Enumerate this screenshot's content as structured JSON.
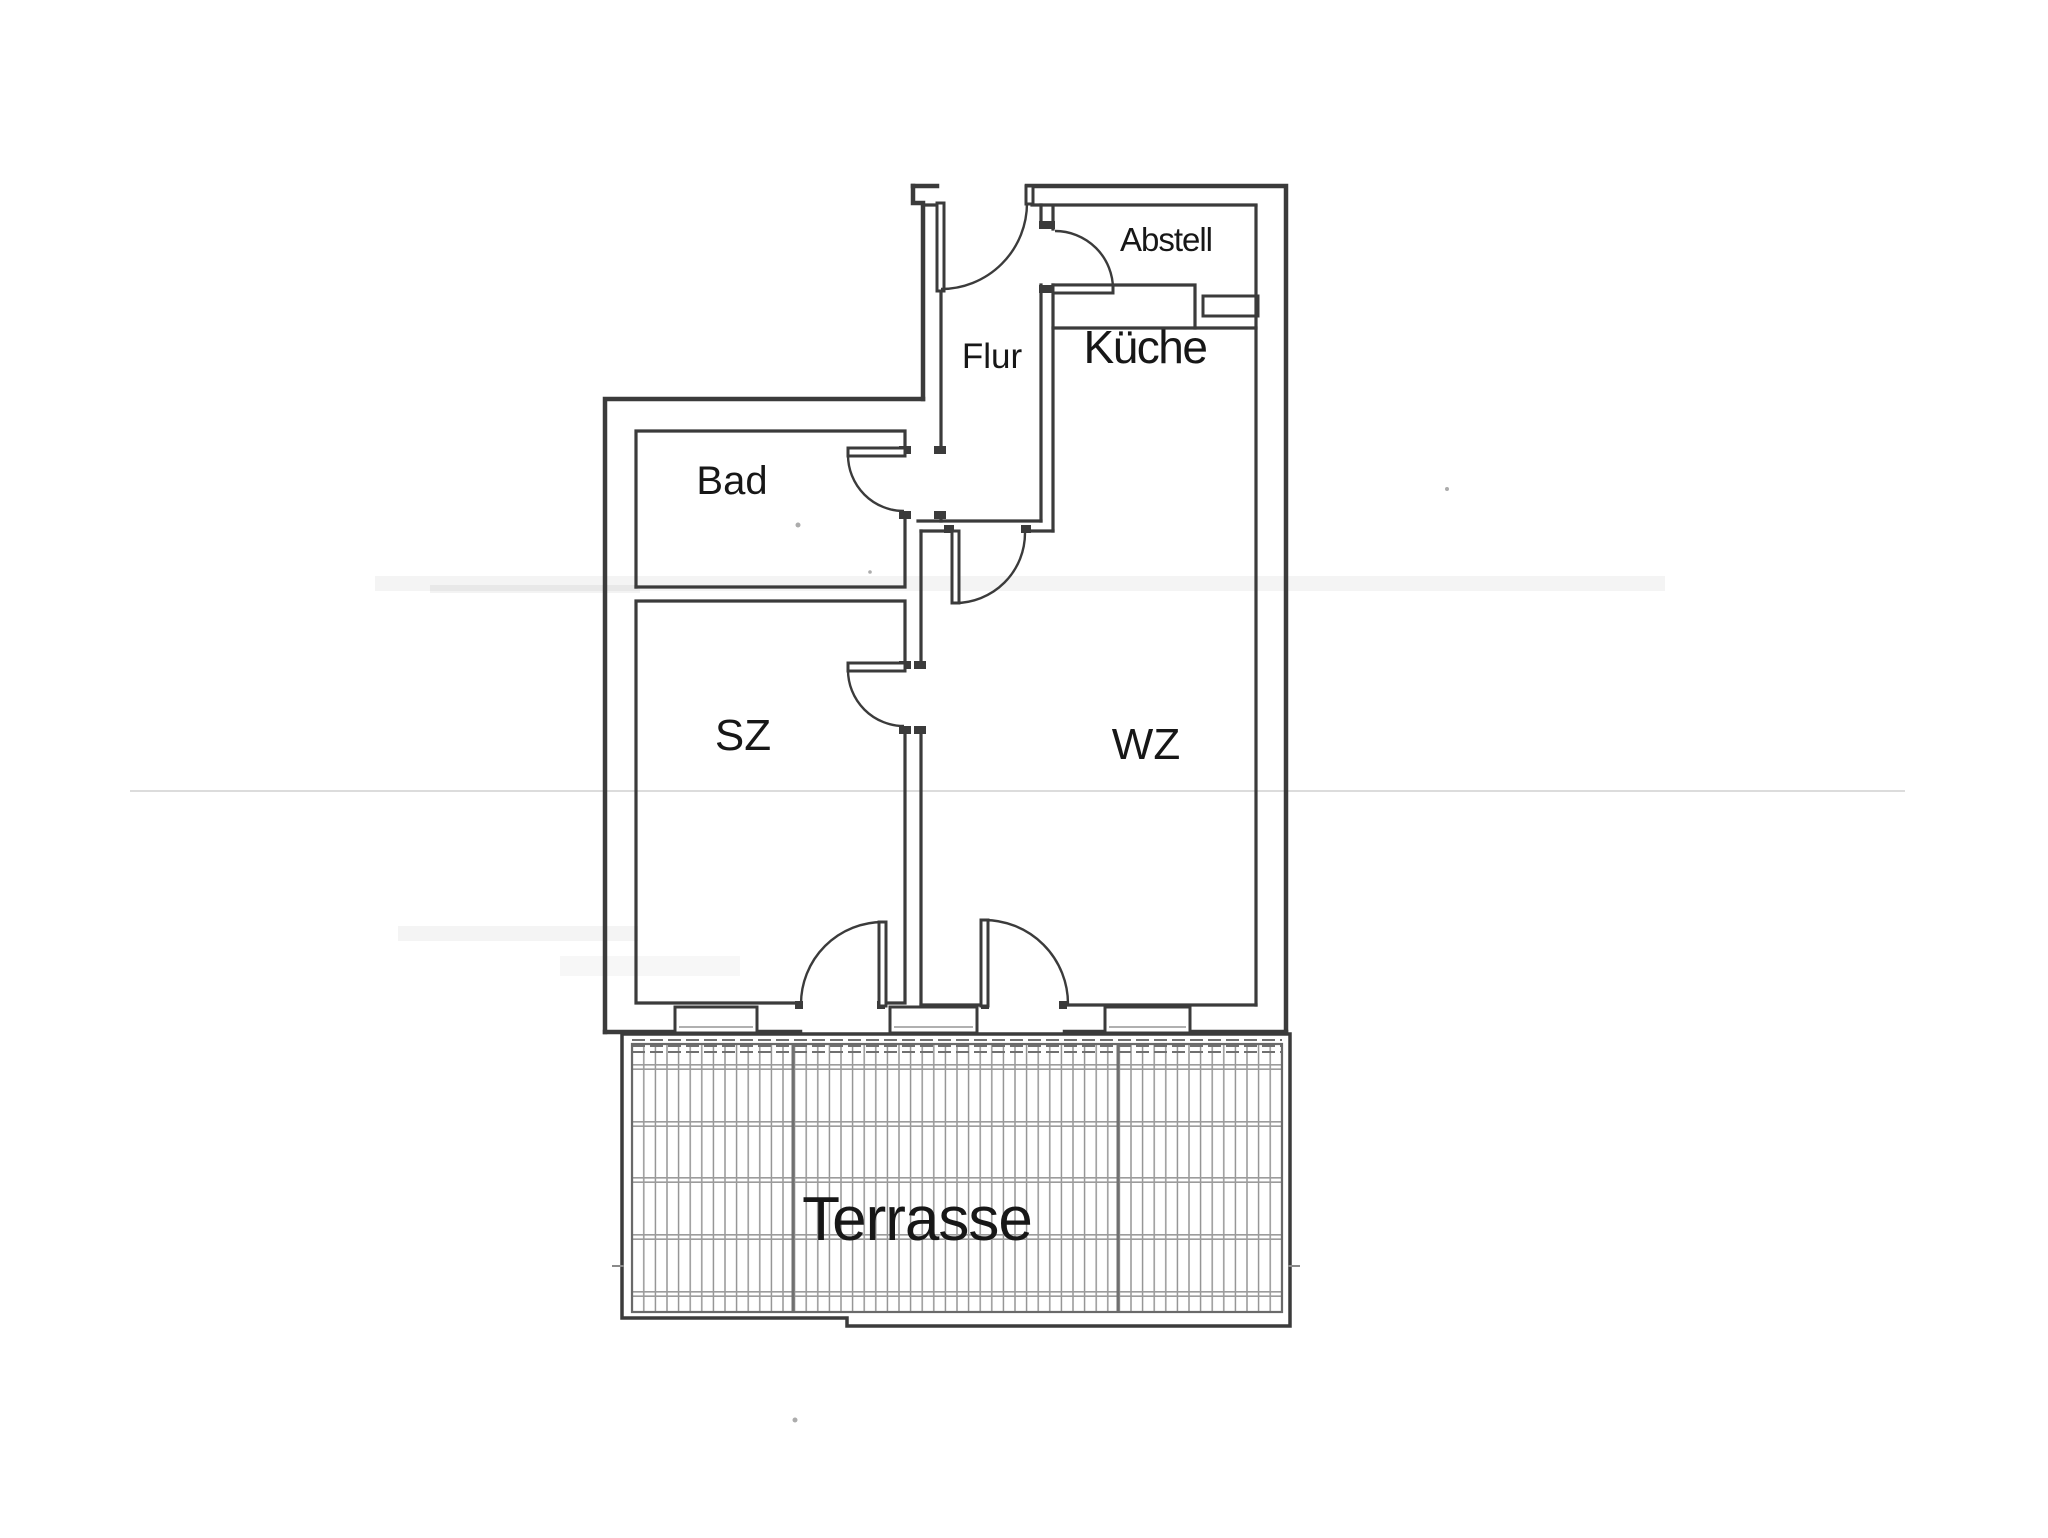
{
  "document": {
    "type": "apartment-floor-plan",
    "background": "#ffffff"
  },
  "colors": {
    "line": "#3b3b3b",
    "label": "#171717",
    "deck": "#8f8f8f",
    "deckrow": "#9c9c9c",
    "deckdiv": "#707070",
    "artifact": "#dcdcdc"
  },
  "rooms": {
    "flur": {
      "label": "Flur"
    },
    "abstell": {
      "label": "Abstell"
    },
    "kueche": {
      "label": "Küche"
    },
    "bad": {
      "label": "Bad"
    },
    "sz": {
      "label": "SZ"
    },
    "wz": {
      "label": "WZ"
    },
    "terrasse": {
      "label": "Terrasse"
    }
  }
}
